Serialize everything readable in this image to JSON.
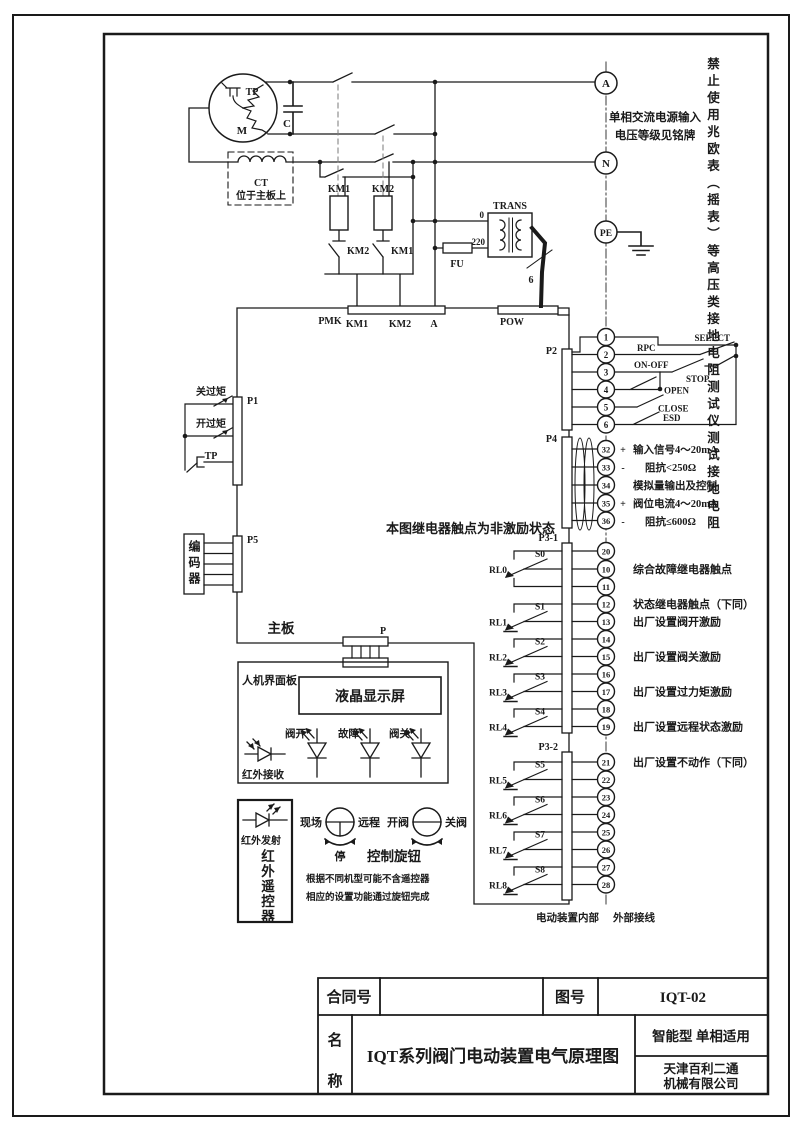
{
  "frame": {
    "warning_vertical": "禁止使用兆欧表（摇表）等高压类接地电阻测试仪测试接地电阻"
  },
  "power": {
    "terminal_a": "A",
    "terminal_n": "N",
    "terminal_pe": "PE",
    "supply_note_1": "单相交流电源输入",
    "supply_note_2": "电压等级见铭牌",
    "motor": "M",
    "motor_tp": "TP",
    "capacitor": "C",
    "ct": "CT",
    "ct_note": "位于主板上",
    "coil_km1": "KM1",
    "coil_km2": "KM2",
    "nc_km2": "KM2",
    "nc_km1": "KM1",
    "pmk": "PMK",
    "pmk_pins": [
      "KM1",
      "KM2",
      "A"
    ],
    "fu": "FU",
    "trans": "TRANS",
    "tap_0": "0",
    "tap_220": "220",
    "wire_count": "6",
    "pow": "POW"
  },
  "mainboard": {
    "label": "主板",
    "relay_note": "本图继电器触点为非激励状态",
    "p_label": "P"
  },
  "left": {
    "p1": "P1",
    "close_torque": "关过矩",
    "open_torque": "开过矩",
    "tp": "TP",
    "p5": "P5",
    "encoder": "编码器"
  },
  "p2": {
    "label": "P2",
    "terminals": [
      "1",
      "2",
      "3",
      "4",
      "5",
      "6"
    ],
    "rpc": "RPC",
    "select": "SELECT",
    "on_off": "ON-OFF",
    "stop": "STOP",
    "open": "OPEN",
    "close": "CLOSE",
    "esd": "ESD"
  },
  "p4": {
    "label": "P4",
    "rows": [
      {
        "n": "32",
        "sign": "+",
        "text": "输入信号4～20mA"
      },
      {
        "n": "33",
        "sign": "-",
        "text": "阻抗<250Ω"
      },
      {
        "n": "34",
        "sign": "",
        "text": "模拟量输出及控制"
      },
      {
        "n": "35",
        "sign": "+",
        "text": "阀位电流4～20mA"
      },
      {
        "n": "36",
        "sign": "-",
        "text": "阻抗≤600Ω"
      }
    ]
  },
  "p3_1": {
    "label": "P3-1",
    "terminals": [
      "20",
      "10",
      "11",
      "12",
      "13",
      "14",
      "15",
      "16",
      "17",
      "18",
      "19"
    ],
    "relays": [
      {
        "name": "RL0",
        "s": "S0"
      },
      {
        "name": "RL1",
        "s": "S1"
      },
      {
        "name": "RL2",
        "s": "S2"
      },
      {
        "name": "RL3",
        "s": "S3"
      },
      {
        "name": "RL4",
        "s": "S4"
      }
    ],
    "ann_10": "综合故障继电器触点",
    "ann_12": "状态继电器触点（下同）",
    "ann_13": "出厂设置阀开激励",
    "ann_15": "出厂设置阀关激励",
    "ann_17": "出厂设置过力矩激励",
    "ann_19": "出厂设置远程状态激励"
  },
  "p3_2": {
    "label": "P3-2",
    "terminals": [
      "21",
      "22",
      "23",
      "24",
      "25",
      "26",
      "27",
      "28"
    ],
    "relays": [
      {
        "name": "RL5",
        "s": "S5"
      },
      {
        "name": "RL6",
        "s": "S6"
      },
      {
        "name": "RL7",
        "s": "S7"
      },
      {
        "name": "RL8",
        "s": "S8"
      }
    ],
    "ann_21": "出厂设置不动作（下同）"
  },
  "boundary": {
    "internal": "电动装置内部",
    "external": "外部接线"
  },
  "hmi": {
    "panel": "人机界面板",
    "lcd": "液晶显示屏",
    "led_open": "阀开",
    "led_fault": "故障",
    "led_close": "阀关",
    "ir_rx": "红外接收"
  },
  "remote": {
    "ir_tx": "红外发射",
    "name_vertical": "红外遥控器",
    "knob1_left": "现场",
    "knob1_right": "远程",
    "knob1_bottom": "停",
    "knob2_left": "开阀",
    "knob2_right": "关阀",
    "knobs_label": "控制旋钮",
    "note_1": "根据不同机型可能不含遥控器",
    "note_2": "相应的设置功能通过旋钮完成"
  },
  "titleblock": {
    "contract_label": "合同号",
    "contract_value": "",
    "drawing_label": "图号",
    "drawing_no": "IQT-02",
    "name_char_1": "名",
    "name_char_2": "称",
    "title": "IQT系列阀门电动装置电气原理图",
    "type_note": "智能型  单相适用",
    "company_line1": "天津百利二通",
    "company_line2": "机械有限公司"
  },
  "colors": {
    "ink": "#1a1a1a",
    "paper": "#ffffff"
  }
}
